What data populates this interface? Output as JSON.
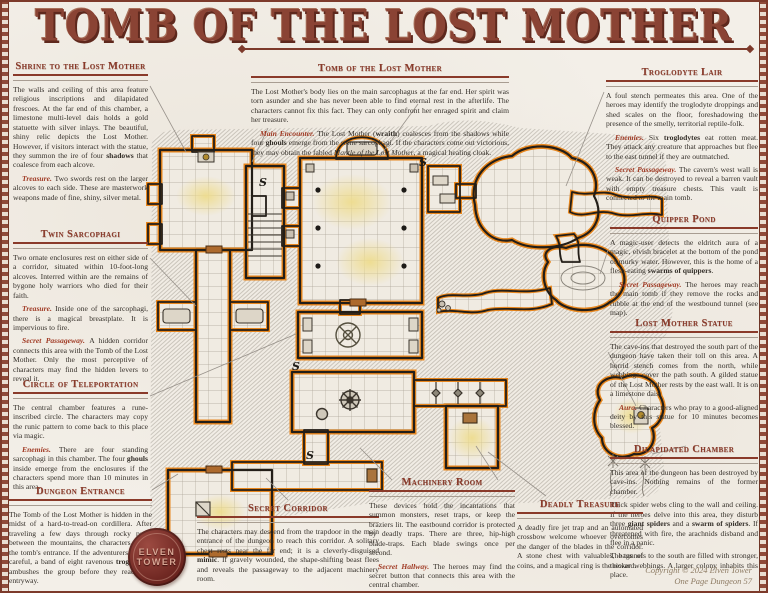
{
  "poster": {
    "title": "TOMB OF THE LOST MOTHER"
  },
  "colors": {
    "accent": "#8a3a2a",
    "lead": "#a03a24",
    "wall_glow": "#e8861c",
    "light_pool": "#eedc8e",
    "parchment": "#f3efe8",
    "seal": "#6b241f"
  },
  "map": {
    "secret_door_marker": "S"
  },
  "logo": {
    "line1": "ELVEN",
    "line2": "TOWER"
  },
  "footer": {
    "line1": "Copyright © 2024 Elven Tower",
    "line2": "One Page Dungeon 57"
  },
  "sections": {
    "shrine": {
      "title": "Shrine to the Lost Mother",
      "paragraphs": [
        {
          "lead": "",
          "text": "The walls and ceiling of this area feature religious inscriptions and dilapidated frescoes. At the far end of this chamber, a limestone multi-level dais holds a gold statuette with silver inlays. The beautiful, shiny relic depicts the Lost Mother. However, if visitors interact with the statue, they summon the ire of four **shadows** that coalesce from each alcove."
        },
        {
          "lead": "Treasure.",
          "text": "Two swords rest on the larger alcoves to each side. These are masterwork weapons made of fine, shiny, silver metal."
        }
      ]
    },
    "twin_sarcophagi": {
      "title": "Twin Sarcophagi",
      "paragraphs": [
        {
          "lead": "",
          "text": "Two ornate enclosures rest on either side of a corridor, situated within 10-foot-long alcoves. Interred within are the remains of bygone holy warriors who died for their faith."
        },
        {
          "lead": "Treasure.",
          "text": "Inside one of the sarcophagi, there is a magical breastplate. It is impervious to fire."
        },
        {
          "lead": "Secret Passageway.",
          "text": "A hidden corridor connects this area with the Tomb of the Lost Mother. Only the most perceptive of characters may find the hidden levers to reveal it."
        }
      ]
    },
    "circle_of_teleportation": {
      "title": "Circle of Teleportation",
      "paragraphs": [
        {
          "lead": "",
          "text": "The central chamber features a rune-inscribed circle. The characters may copy the runic pattern to come back to this place via magic."
        },
        {
          "lead": "Enemies.",
          "text": "There are four standing sarcophagi in this chamber. The four **ghouls** inside emerge from the enclosures if the characters spend more than 10 minutes in this area."
        }
      ]
    },
    "dungeon_entrance": {
      "title": "Dungeon Entrance",
      "paragraphs": [
        {
          "lead": "",
          "text": "The Tomb of the Lost Mother is hidden in the midst of a hard-to-tread-on cordillera. After traveling a few days through rocky paths between the mountains, the characters locate the tomb's entrance. If the adventurers are not careful, a band of eight ravenous **troglodytes** ambushes the group before they reach the entryway."
        }
      ]
    },
    "tomb": {
      "title": "Tomb of the Lost Mother",
      "paragraphs": [
        {
          "lead": "",
          "text": "The Lost Mother's body lies on the main sarcophagus at the far end. Her spirit was torn asunder and she has never been able to find eternal rest in the afterlife. The characters cannot fix this fact. They can only confront her enraged spirit and claim her treasure."
        },
        {
          "lead": "Main Encounter.",
          "text": "The Lost Mother (**wraith**) coalesces from the shadows while four **ghouls** emerge from the stone sarcophagi. If the characters come out victorious, they may obtain the fabled *Mantle of the Lost Mother*, a magical healing cloak."
        }
      ]
    },
    "troglodyte_lair": {
      "title": "Troglodyte Lair",
      "paragraphs": [
        {
          "lead": "",
          "text": "A foul stench permeates this area. One of the heroes may identify the troglodyte droppings and shed scales on the floor, foreshadowing the presence of the smelly, territorial reptile-folk."
        },
        {
          "lead": "Enemies.",
          "text": "Six **troglodytes** eat rotten meat. They attack any creature that approaches but flee to the east tunnel if they are outmatched."
        },
        {
          "lead": "Secret Passageway.",
          "text": "The cavern's west wall is weak. It can be destroyed to reveal a barren vault with empty treasure chests. This vault is connected to the main tomb."
        }
      ]
    },
    "quipper_pond": {
      "title": "Quipper Pond",
      "paragraphs": [
        {
          "lead": "",
          "text": "A magic-user detects the eldritch aura of a magic, elvish bracelet at the bottom of the pond of murky water. However, this is the home of a flesh-eating **swarms of quippers**."
        },
        {
          "lead": "Secret Passageway.",
          "text": "The heroes may reach the main tomb if they remove the rocks and rubble at the end of the westbound tunnel (see map)."
        }
      ]
    },
    "lost_mother_statue": {
      "title": "Lost Mother Statue",
      "paragraphs": [
        {
          "lead": "",
          "text": "The cave-ins that destroyed the south part of the dungeon have taken their toll on this area. A horrid stench comes from the north, while webbings cover the path south. A gilded statue of the Lost Mother rests by the east wall. It is on a limestone dais."
        },
        {
          "lead": "Aura.",
          "text": "Characters who pray to a good-aligned deity by this statue for 10 minutes becomes blessed."
        }
      ]
    },
    "dilapidated_chamber": {
      "title": "Dilapidated Chamber",
      "paragraphs": [
        {
          "lead": "",
          "text": "This area of the dungeon has been destroyed by cave-ins. Nothing remains of the former chamber."
        },
        {
          "lead": "",
          "text": "Thick spider webs cling to the wall and ceiling. If the heroes delve into this area, they disturb three **giant spiders** and a **swarm of spiders**. If threatened with fire, the arachnids disband and flee in a panic."
        },
        {
          "lead": "",
          "text": "The tunnels to the south are filled with stronger, thicker webbings. A larger colony inhabits this place."
        }
      ]
    },
    "secret_corridor": {
      "title": "Secret Corridor",
      "paragraphs": [
        {
          "lead": "",
          "text": "The characters may descend from the trapdoor in the main entrance of the dungeon to reach this corridor. A solitary chest rests near the far end; it is a cleverly-disguised **mimic**. If gravely wounded, the shape-shifting beast flees and reveals the passageway to the adjacent machinery room."
        }
      ]
    },
    "machinery_room": {
      "title": "Machinery Room",
      "paragraphs": [
        {
          "lead": "",
          "text": "These devices hold the incantations that summon monsters, reset traps, or keep the braziers lit. The eastbound corridor is protected by deadly traps. There are three, hip-high blade-traps. Each blade swings once per second."
        },
        {
          "lead": "Secret Hallway.",
          "text": "The heroes may find the secret button that connects this area with the central chamber."
        }
      ]
    },
    "deadly_treasure": {
      "title": "Deadly Treasure",
      "paragraphs": [
        {
          "lead": "",
          "text": "A deadly fire jet trap and an automated crossbow welcome whoever overcomes the danger of the blades in the corridor. A stone chest with valuables, bags of coins, and a magical ring is the reward."
        }
      ]
    }
  }
}
